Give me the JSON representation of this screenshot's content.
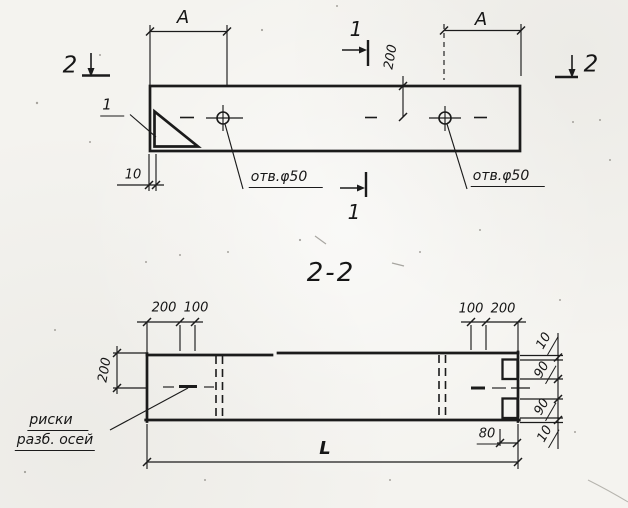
{
  "drawing": {
    "ink_color": "#1b1b1b",
    "paper_color": "#f4f3ef",
    "plan": {
      "section_mark_2_left": "2",
      "section_mark_2_right": "2",
      "section_mark_1_top": "1",
      "section_mark_1_bottom": "1",
      "dim_a_left": "A",
      "dim_a_right": "A",
      "dim_200": "200",
      "dim_10": "10",
      "detail_ref": "1",
      "hole_label_left": "отв.φ50",
      "hole_label_right": "отв.φ50"
    },
    "section": {
      "title": "2-2",
      "dim_top_left_200": "200",
      "dim_top_left_100": "100",
      "dim_top_right_100": "100",
      "dim_top_right_200": "200",
      "dim_height_200": "200",
      "chain": [
        "10",
        "90",
        "90",
        "10"
      ],
      "dim_80": "80",
      "dim_length": "L",
      "note_line1": "риски",
      "note_line2": "разб. осей"
    }
  }
}
